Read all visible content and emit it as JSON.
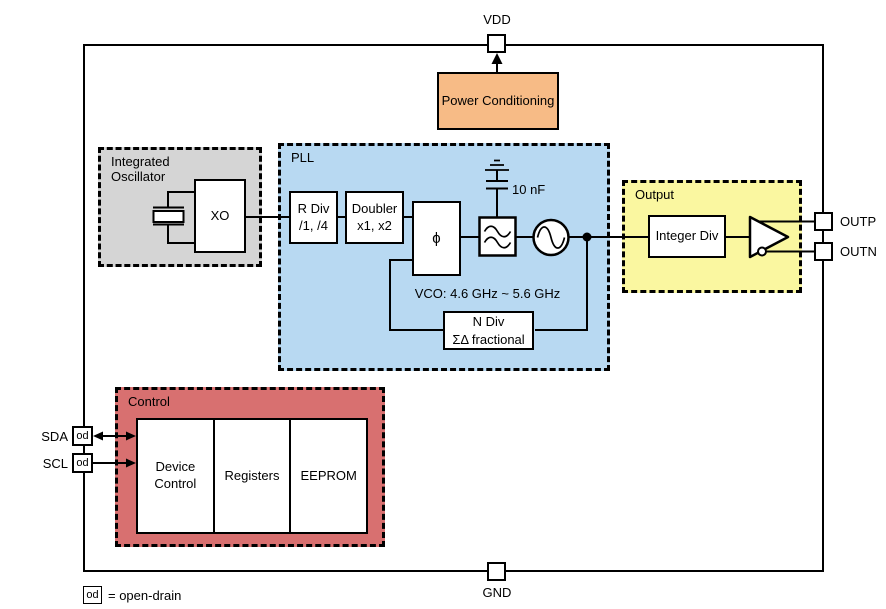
{
  "colors": {
    "orange": "#F7BB86",
    "gray": "#D5D5D5",
    "blue": "#B8D9F2",
    "yellow": "#FAF7A0",
    "red": "#D87070"
  },
  "pins": {
    "vdd": "VDD",
    "gnd": "GND",
    "outp": "OUTP",
    "outn": "OUTN",
    "sda": "SDA",
    "scl": "SCL",
    "od": "od"
  },
  "legend": {
    "od": "od",
    "text": "= open-drain"
  },
  "regions": {
    "oscillator": {
      "label": "Integrated Oscillator"
    },
    "pll": {
      "label": "PLL"
    },
    "output": {
      "label": "Output"
    },
    "control": {
      "label": "Control"
    }
  },
  "blocks": {
    "power_conditioning": {
      "label": "Power Conditioning"
    },
    "xo": {
      "label": "XO"
    },
    "r_div": {
      "line1": "R Div",
      "line2": "/1, /4"
    },
    "doubler": {
      "line1": "Doubler",
      "line2": "x1, x2"
    },
    "phase_detector": {
      "symbol": "ϕ"
    },
    "n_div": {
      "line1": "N Div",
      "line2": "ΣΔ fractional"
    },
    "integer_div": {
      "label": "Integer Div"
    },
    "device_control": {
      "label": "Device Control"
    },
    "registers": {
      "label": "Registers"
    },
    "eeprom": {
      "label": "EEPROM"
    }
  },
  "annotations": {
    "capacitor_value": "10 nF",
    "vco_range": "VCO: 4.6 GHz ~ 5.6 GHz"
  }
}
